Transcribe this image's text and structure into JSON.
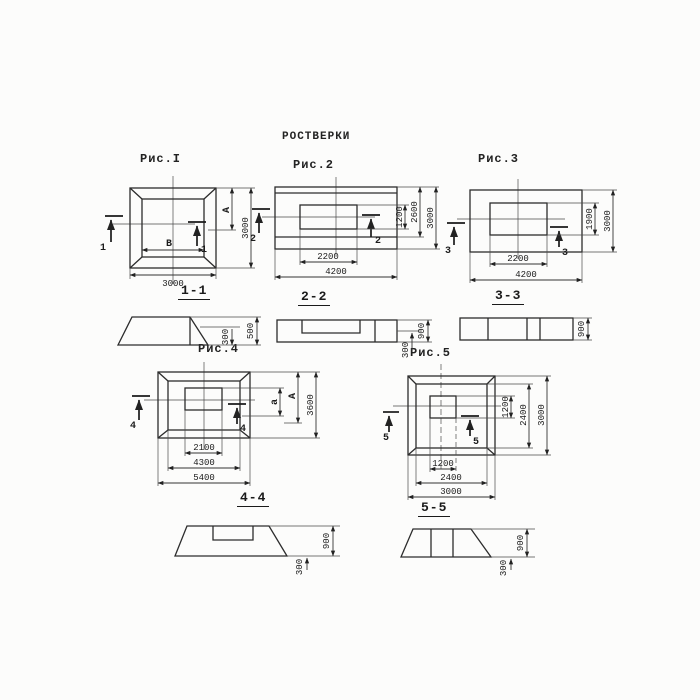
{
  "title": "РОСТВЕРКИ",
  "fig1": {
    "label": "Рис.I",
    "section": "1-1",
    "cut": "1",
    "inner_w": "В",
    "outer_w": "3000",
    "inner_h": "А",
    "outer_h": "3000",
    "sec_edge": "300",
    "sec_total": "500"
  },
  "fig2": {
    "label": "Рис.2",
    "section": "2-2",
    "cut": "2",
    "inner_w": "2200",
    "outer_w": "4200",
    "inner_h": "1200",
    "mid_h": "2600",
    "outer_h": "3000",
    "sec_edge": "300",
    "sec_total": "900"
  },
  "fig3": {
    "label": "Рис.3",
    "section": "3-3",
    "cut": "3",
    "inner_w": "2200",
    "outer_w": "4200",
    "inner_h": "1900",
    "outer_h": "3000",
    "sec_total": "900"
  },
  "fig4": {
    "label": "Рис.4",
    "section": "4-4",
    "cut": "4",
    "inner_w": "2100",
    "mid_w": "4300",
    "outer_w": "5400",
    "inner_h": "а",
    "mid_h": "А",
    "outer_h": "3600",
    "sec_edge": "300",
    "sec_total": "900"
  },
  "fig5": {
    "label": "Рис.5",
    "section": "5-5",
    "cut": "5",
    "inner_w": "1200",
    "mid_w": "2400",
    "outer_w": "3000",
    "inner_h": "1200",
    "mid_h": "2400",
    "outer_h": "3000",
    "sec_edge": "300",
    "sec_total": "900"
  }
}
